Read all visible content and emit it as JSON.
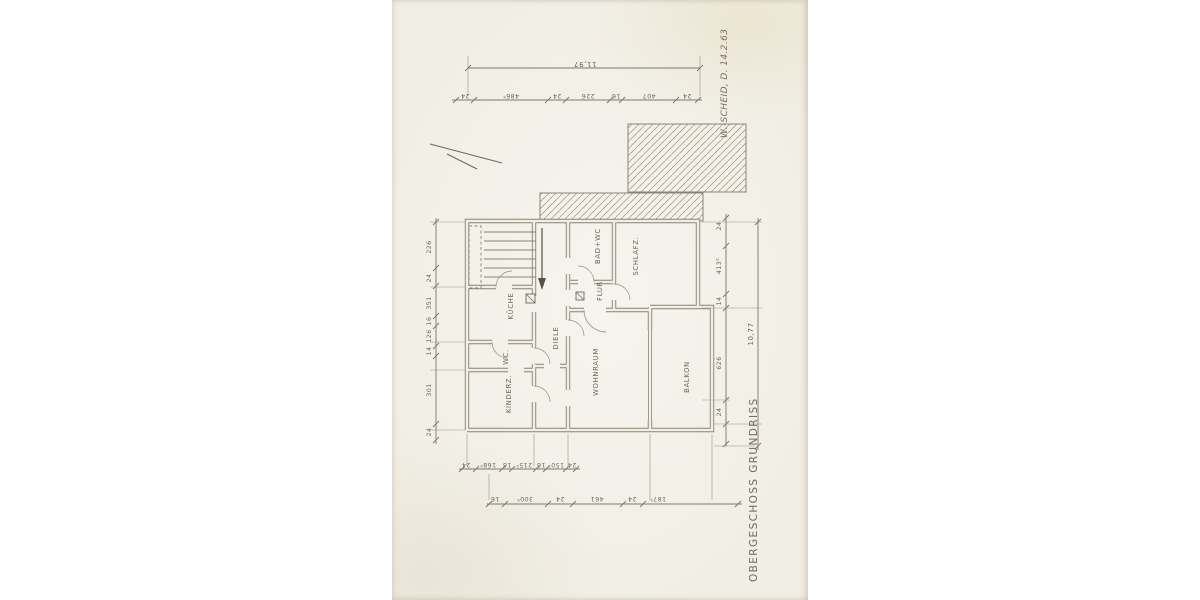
{
  "annotations": {
    "title": "OBERGESCHOSS GRUNDRISS",
    "signature": "W.-SCHEID, D. 14.2.63"
  },
  "plan": {
    "rooms": {
      "kueche": "KÜCHE",
      "diele": "DIELE",
      "bad_wc": "BAD+WC",
      "flur": "FLUR",
      "schlafz": "SCHLAFZ.",
      "wc": "WC.",
      "kinderz": "KINDERZ.",
      "wohnraum": "WOHNRAUM",
      "balkon": "BALKON"
    }
  },
  "dimensions": {
    "top_overall": "11,97",
    "right_overall": "10,77",
    "top_chain": [
      "24",
      "486⁵",
      "24",
      "226",
      "16",
      "407",
      "24"
    ],
    "left_chain": [
      "226",
      "24",
      "351",
      "16",
      "126",
      "14",
      "301",
      "24"
    ],
    "right_chain": [
      "24",
      "413⁵",
      "14",
      "626",
      "24"
    ],
    "bottom_inner_chain": [
      "24",
      "168⁵",
      "16",
      "215²",
      "16",
      "150¹",
      "24"
    ],
    "bottom_outer_chain": [
      "16",
      "300⁵",
      "24",
      "461",
      "24",
      "187⁵"
    ]
  },
  "colors": {
    "paper": "#f1eee5",
    "pencil": "#8a8478",
    "hatch": "#a89f8d",
    "text": "#6c665a"
  }
}
